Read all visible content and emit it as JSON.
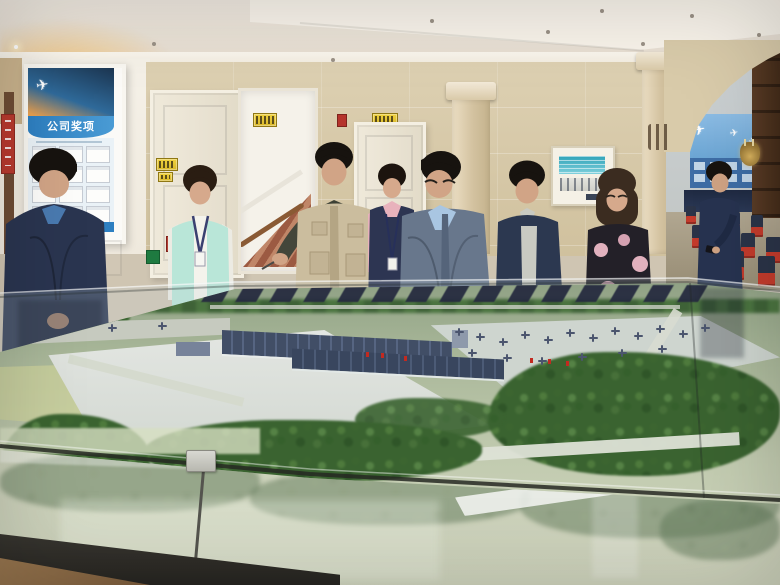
{
  "labels": {
    "poster_title": "公司奖项"
  },
  "icons": {
    "airplane_glyph": "✈"
  },
  "palette": {
    "wall_beige": "#d8caab",
    "wall_white": "#f3efe6",
    "poster_blue": "#2d7fc1",
    "mint_vest": "#b9e6d8",
    "khaki_vest": "#cbbd9e",
    "navy_jacket": "#28334d",
    "pink_floral": "#ecb9c6",
    "model_green": "#3a6330",
    "chair_red": "#c33b2c",
    "sign_yellow": "#e8c832",
    "display_teal": "#2fa3b8"
  }
}
